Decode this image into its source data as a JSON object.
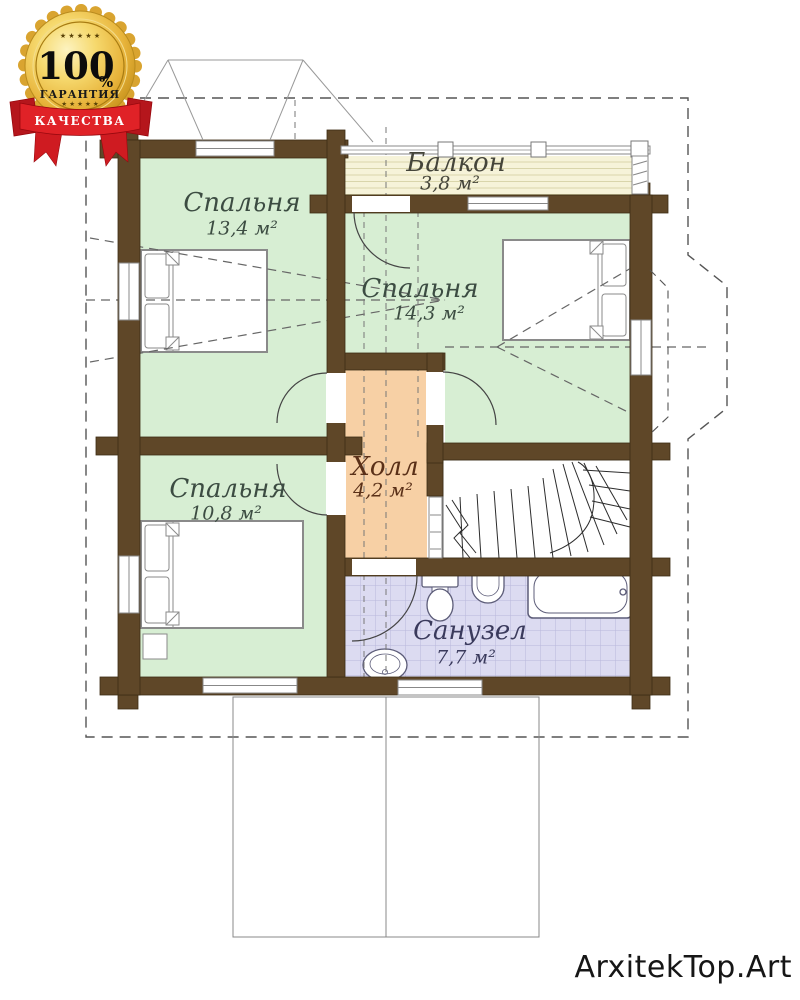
{
  "badge": {
    "percent": "100",
    "percent_sign": "%",
    "guarantee": "ГАРАНТИЯ",
    "quality": "КАЧЕСТВА",
    "stars_top": "★ ★ ★ ★ ★",
    "stars_bottom": "★ ★ ★ ★ ★",
    "gold_color": "#e7b33a",
    "ribbon_color": "#d61f26"
  },
  "watermark": {
    "text": "ArxitekTop.Art",
    "color": "#161616"
  },
  "plan": {
    "wall_color": "#5f4728",
    "outline_style": "dashed",
    "rooms": [
      {
        "id": "balcony",
        "name": "Балкон",
        "area": "3,8 м²",
        "floor_color": "#f6f3d9"
      },
      {
        "id": "bedroom-top-left",
        "name": "Спальня",
        "area": "13,4 м²",
        "floor_color": "#d7eed3"
      },
      {
        "id": "bedroom-right",
        "name": "Спальня",
        "area": "14,3 м²",
        "floor_color": "#d7eed3"
      },
      {
        "id": "bedroom-bottom-left",
        "name": "Спальня",
        "area": "10,8 м²",
        "floor_color": "#d7eed3"
      },
      {
        "id": "hall",
        "name": "Холл",
        "area": "4,2 м²",
        "floor_color": "#f7d0a5"
      },
      {
        "id": "bathroom",
        "name": "Санузел",
        "area": "7,7 м²",
        "floor_color": "#dcdbf1"
      }
    ]
  }
}
